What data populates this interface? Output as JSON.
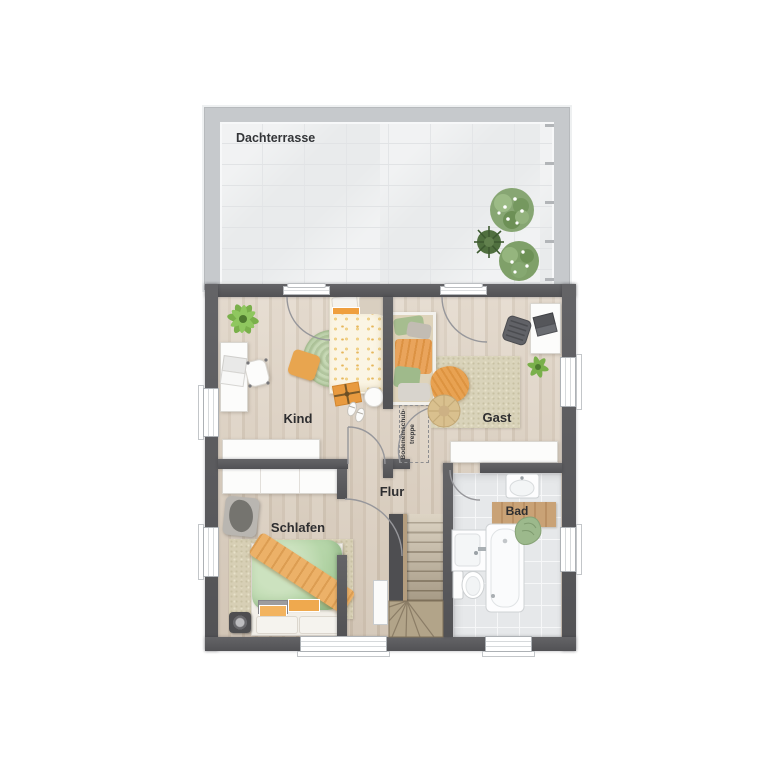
{
  "plan": {
    "rooms": {
      "terrace": {
        "label": "Dachterrasse"
      },
      "kind": {
        "label": "Kind"
      },
      "gast": {
        "label": "Gast"
      },
      "flur": {
        "label": "Flur"
      },
      "schlafen": {
        "label": "Schlafen"
      },
      "bad": {
        "label": "Bad"
      },
      "attic_hatch": {
        "label_line1": "Bodeneinschub-",
        "label_line2": "treppe"
      }
    },
    "colors": {
      "wall_dark": "#58585b",
      "terrace_wall": "#c6c9cc",
      "wood_floor": "#d8ccbd",
      "tile_floor": "#e6e8ea",
      "accent_green": "#b7d3aa",
      "accent_orange": "#e9a95e",
      "label_text": "#2e2e30"
    }
  }
}
